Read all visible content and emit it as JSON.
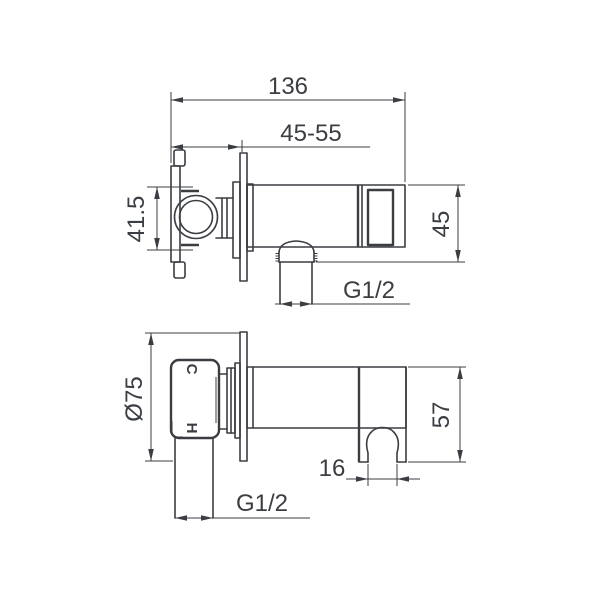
{
  "drawing_type": "technical-drawing-shower-outlet-holder",
  "colors": {
    "line": "#3a3d42",
    "background": "#ffffff"
  },
  "side_view": {
    "total_length": "136",
    "wall_depth_range": "45-55",
    "body_height": "41.5",
    "end_height": "45",
    "outlet_thread": "G1/2"
  },
  "plan_view": {
    "flange_diameter": "Ø75",
    "end_depth": "57",
    "notch_width": "16",
    "inlet_thread": "G1/2",
    "cold_label": "C",
    "hot_label": "H"
  }
}
